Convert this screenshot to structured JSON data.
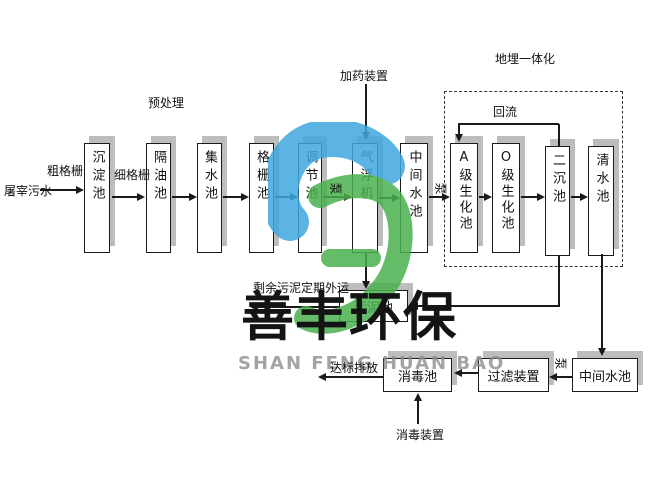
{
  "diagram": {
    "source_label": "屠宰污水",
    "pretreatment_label": "预处理",
    "dosing_device_label": "加药装置",
    "buried_integration_label": "地埋一体化",
    "reflux_label": "回流",
    "coarse_screen_label": "粗格栅",
    "fine_screen_label": "细格栅",
    "pump_label": "泵",
    "sludge_out_label": "剩余污泥定期外运",
    "discharge_label": "达标排放",
    "disinfect_device_label": "消毒装置",
    "tanks_top": [
      "沉淀池",
      "隔油池",
      "集水池",
      "格栅池",
      "调节池",
      "气浮机",
      "中间水池",
      "A级生化池",
      "O级生化池",
      "二沉池",
      "清水池"
    ],
    "sludge_tank": "污泥池",
    "disinfection_tank": "消毒池",
    "filter_device": "过滤装置",
    "intermediate_tank_bottom": "中间水池"
  },
  "watermark": {
    "cn": "善丰环保",
    "en": "SHAN FENG HUAN BAO",
    "blue": "#3fa7df",
    "green": "#4ab04e"
  },
  "colors": {
    "line": "#1a1a1a",
    "shadow": "#bdbdbd",
    "border_dashed": "#333333"
  }
}
